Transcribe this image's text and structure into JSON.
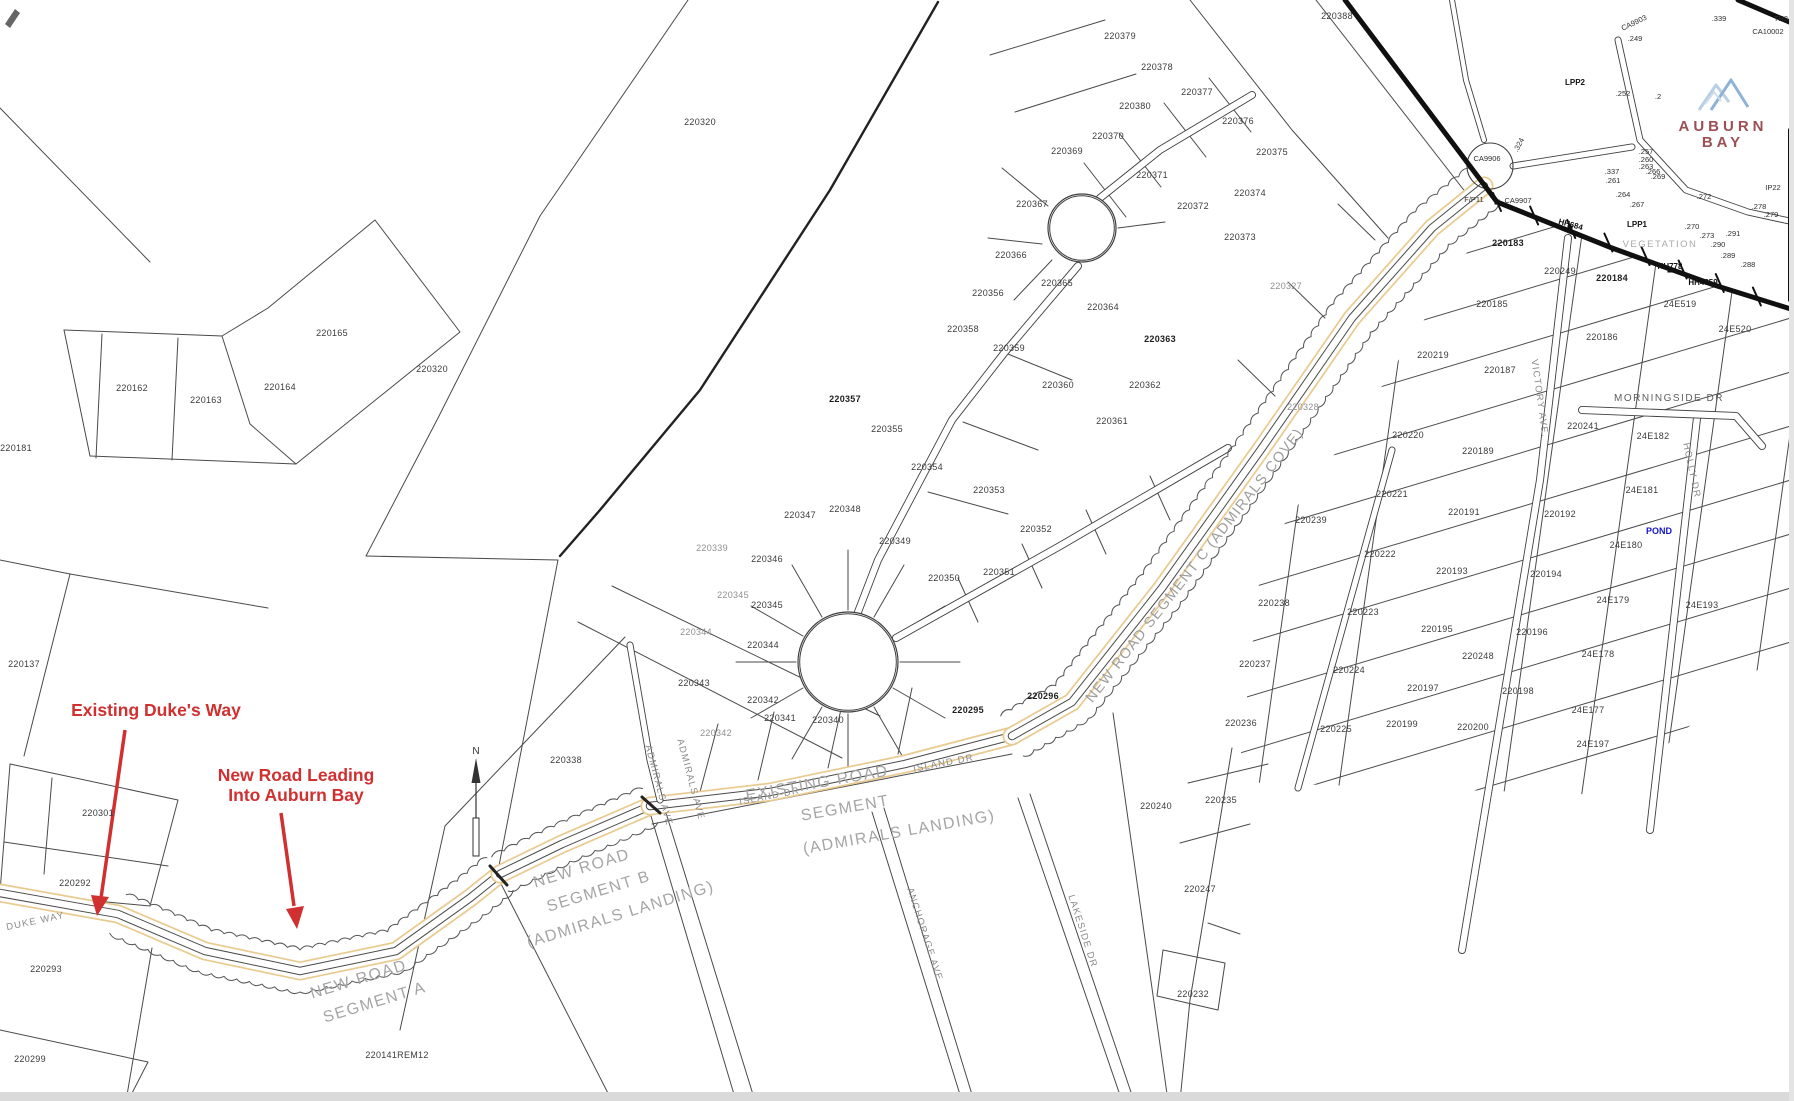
{
  "page": {
    "background": "#ffffff"
  },
  "colors": {
    "annotation_red": "#d03030",
    "road_orange": "#e9cb90",
    "pond_blue": "#1414cc",
    "logo_blue": "#a3c2de",
    "logo_text": "#9a5054",
    "line": "#3c3c3c",
    "segment_text_gray": "#a5a5a5",
    "edge_strip": "#dadada"
  },
  "logo": {
    "line1": "AUBURN",
    "line2": "BAY"
  },
  "annotations": {
    "existing_label": "Existing Duke's Way",
    "new_road_line1": "New Road Leading",
    "new_road_line2": "Into Auburn Bay"
  },
  "north": {
    "label": "N"
  },
  "map": {
    "labels": [
      {
        "t": "220388",
        "x": 1337,
        "y": 19
      },
      {
        "t": "220379",
        "x": 1120,
        "y": 39
      },
      {
        "t": "220378",
        "x": 1157,
        "y": 70
      },
      {
        "t": "220377",
        "x": 1197,
        "y": 95
      },
      {
        "t": "220376",
        "x": 1238,
        "y": 124
      },
      {
        "t": "220375",
        "x": 1272,
        "y": 155
      },
      {
        "t": "220380",
        "x": 1135,
        "y": 109
      },
      {
        "t": "220370",
        "x": 1108,
        "y": 139
      },
      {
        "t": "220369",
        "x": 1067,
        "y": 154
      },
      {
        "t": "220371",
        "x": 1152,
        "y": 178
      },
      {
        "t": "220367",
        "x": 1032,
        "y": 207
      },
      {
        "t": "220372",
        "x": 1193,
        "y": 209
      },
      {
        "t": "220374",
        "x": 1250,
        "y": 196
      },
      {
        "t": "220373",
        "x": 1240,
        "y": 240
      },
      {
        "t": "220366",
        "x": 1011,
        "y": 258
      },
      {
        "t": "220365",
        "x": 1057,
        "y": 286
      },
      {
        "t": "220364",
        "x": 1103,
        "y": 310
      },
      {
        "t": "220363",
        "x": 1160,
        "y": 342,
        "c": "b"
      },
      {
        "t": "220356",
        "x": 988,
        "y": 296
      },
      {
        "t": "220357",
        "x": 845,
        "y": 402,
        "c": "b"
      },
      {
        "t": "220358",
        "x": 963,
        "y": 332
      },
      {
        "t": "220359",
        "x": 1009,
        "y": 351
      },
      {
        "t": "220360",
        "x": 1058,
        "y": 388
      },
      {
        "t": "220362",
        "x": 1145,
        "y": 388
      },
      {
        "t": "220361",
        "x": 1112,
        "y": 424
      },
      {
        "t": "220355",
        "x": 887,
        "y": 432
      },
      {
        "t": "220354",
        "x": 927,
        "y": 470
      },
      {
        "t": "220353",
        "x": 989,
        "y": 493
      },
      {
        "t": "220352",
        "x": 1036,
        "y": 532
      },
      {
        "t": "220351",
        "x": 999,
        "y": 575
      },
      {
        "t": "220350",
        "x": 944,
        "y": 581
      },
      {
        "t": "220349",
        "x": 895,
        "y": 544
      },
      {
        "t": "220348",
        "x": 845,
        "y": 512
      },
      {
        "t": "220347",
        "x": 800,
        "y": 518
      },
      {
        "t": "220346",
        "x": 767,
        "y": 562
      },
      {
        "t": "220345",
        "x": 733,
        "y": 598,
        "c": "g"
      },
      {
        "t": "220345",
        "x": 767,
        "y": 608
      },
      {
        "t": "220344",
        "x": 696,
        "y": 635,
        "c": "g"
      },
      {
        "t": "220344",
        "x": 763,
        "y": 648
      },
      {
        "t": "220343",
        "x": 694,
        "y": 686
      },
      {
        "t": "220342",
        "x": 763,
        "y": 703
      },
      {
        "t": "220342",
        "x": 716,
        "y": 736,
        "c": "g"
      },
      {
        "t": "220341",
        "x": 780,
        "y": 721
      },
      {
        "t": "220340",
        "x": 828,
        "y": 723
      },
      {
        "t": "220339",
        "x": 712,
        "y": 551,
        "c": "g"
      },
      {
        "t": "220338",
        "x": 566,
        "y": 763
      },
      {
        "t": "220320",
        "x": 700,
        "y": 125
      },
      {
        "t": "220320",
        "x": 432,
        "y": 372
      },
      {
        "t": "220162",
        "x": 132,
        "y": 391
      },
      {
        "t": "220163",
        "x": 206,
        "y": 403
      },
      {
        "t": "220164",
        "x": 280,
        "y": 390
      },
      {
        "t": "220165",
        "x": 332,
        "y": 336
      },
      {
        "t": "220181",
        "x": 16,
        "y": 451
      },
      {
        "t": "220137",
        "x": 24,
        "y": 667
      },
      {
        "t": "220301",
        "x": 98,
        "y": 816
      },
      {
        "t": "220292",
        "x": 75,
        "y": 886
      },
      {
        "t": "220293",
        "x": 46,
        "y": 972
      },
      {
        "t": "220299",
        "x": 30,
        "y": 1062
      },
      {
        "t": "220141REM12",
        "x": 397,
        "y": 1058
      },
      {
        "t": "220295",
        "x": 968,
        "y": 713,
        "c": "b"
      },
      {
        "t": "220296",
        "x": 1043,
        "y": 699,
        "c": "b"
      },
      {
        "t": "220183",
        "x": 1508,
        "y": 246,
        "c": "b"
      },
      {
        "t": "220249",
        "x": 1560,
        "y": 274
      },
      {
        "t": "220184",
        "x": 1612,
        "y": 281,
        "c": "b"
      },
      {
        "t": "24E519",
        "x": 1680,
        "y": 307
      },
      {
        "t": "24E520",
        "x": 1735,
        "y": 332
      },
      {
        "t": "220185",
        "x": 1492,
        "y": 307
      },
      {
        "t": "220186",
        "x": 1602,
        "y": 340
      },
      {
        "t": "220219",
        "x": 1433,
        "y": 358
      },
      {
        "t": "220187",
        "x": 1500,
        "y": 373
      },
      {
        "t": "220327",
        "x": 1286,
        "y": 289,
        "c": "g"
      },
      {
        "t": "220328",
        "x": 1303,
        "y": 410,
        "c": "g"
      },
      {
        "t": "220241",
        "x": 1583,
        "y": 429
      },
      {
        "t": "24E182",
        "x": 1653,
        "y": 439
      },
      {
        "t": "220220",
        "x": 1408,
        "y": 438
      },
      {
        "t": "220189",
        "x": 1478,
        "y": 454
      },
      {
        "t": "24E181",
        "x": 1642,
        "y": 493
      },
      {
        "t": "220221",
        "x": 1392,
        "y": 497
      },
      {
        "t": "220191",
        "x": 1464,
        "y": 515
      },
      {
        "t": "220192",
        "x": 1560,
        "y": 517
      },
      {
        "t": "24E180",
        "x": 1626,
        "y": 548
      },
      {
        "t": "220222",
        "x": 1380,
        "y": 557
      },
      {
        "t": "220193",
        "x": 1452,
        "y": 574
      },
      {
        "t": "220194",
        "x": 1546,
        "y": 577
      },
      {
        "t": "24E179",
        "x": 1613,
        "y": 603
      },
      {
        "t": "24E193",
        "x": 1702,
        "y": 608
      },
      {
        "t": "220239",
        "x": 1311,
        "y": 523
      },
      {
        "t": "220238",
        "x": 1274,
        "y": 606
      },
      {
        "t": "220223",
        "x": 1363,
        "y": 615
      },
      {
        "t": "220195",
        "x": 1437,
        "y": 632
      },
      {
        "t": "220196",
        "x": 1532,
        "y": 635
      },
      {
        "t": "24E178",
        "x": 1598,
        "y": 657
      },
      {
        "t": "220237",
        "x": 1255,
        "y": 667
      },
      {
        "t": "220224",
        "x": 1349,
        "y": 673
      },
      {
        "t": "220248",
        "x": 1478,
        "y": 659
      },
      {
        "t": "220197",
        "x": 1423,
        "y": 691
      },
      {
        "t": "220198",
        "x": 1518,
        "y": 694
      },
      {
        "t": "24E177",
        "x": 1588,
        "y": 713
      },
      {
        "t": "220236",
        "x": 1241,
        "y": 726
      },
      {
        "t": "220225",
        "x": 1336,
        "y": 732
      },
      {
        "t": "220199",
        "x": 1402,
        "y": 727
      },
      {
        "t": "220200",
        "x": 1473,
        "y": 730
      },
      {
        "t": "24E197",
        "x": 1593,
        "y": 747
      },
      {
        "t": "220240",
        "x": 1156,
        "y": 809
      },
      {
        "t": "220235",
        "x": 1221,
        "y": 803
      },
      {
        "t": "220247",
        "x": 1200,
        "y": 892
      },
      {
        "t": "220232",
        "x": 1193,
        "y": 997
      },
      {
        "t": "CA9903",
        "x": 1635,
        "y": 25,
        "r": -25,
        "c": "tiny"
      },
      {
        "t": "CA10002",
        "x": 1768,
        "y": 34,
        "c": "tiny"
      },
      {
        "t": "TH34",
        "x": 1783,
        "y": 21,
        "c": "tiny"
      },
      {
        "t": ".339",
        "x": 1719,
        "y": 21,
        "c": "tiny"
      },
      {
        "t": ".249",
        "x": 1635,
        "y": 41,
        "c": "tiny"
      },
      {
        "t": "LPP2",
        "x": 1575,
        "y": 85,
        "c": "tinyb"
      },
      {
        "t": ".252",
        "x": 1623,
        "y": 96,
        "c": "tiny"
      },
      {
        "t": ".2",
        "x": 1658,
        "y": 99,
        "c": "tiny"
      },
      {
        "t": "CA9906",
        "x": 1487,
        "y": 161,
        "c": "tiny"
      },
      {
        "t": ".324",
        "x": 1521,
        "y": 146,
        "r": -62,
        "c": "tiny"
      },
      {
        "t": ".337",
        "x": 1612,
        "y": 174,
        "c": "tiny"
      },
      {
        "t": ".261",
        "x": 1613,
        "y": 183,
        "c": "tiny"
      },
      {
        "t": ".257",
        "x": 1646,
        "y": 154,
        "c": "tiny"
      },
      {
        "t": ".260",
        "x": 1646,
        "y": 162,
        "c": "tiny"
      },
      {
        "t": ".263",
        "x": 1646,
        "y": 169,
        "c": "tiny"
      },
      {
        "t": ".266",
        "x": 1653,
        "y": 174,
        "c": "tiny"
      },
      {
        "t": ".269",
        "x": 1658,
        "y": 179,
        "c": "tiny"
      },
      {
        "t": ".264",
        "x": 1623,
        "y": 197,
        "c": "tiny"
      },
      {
        "t": ".267",
        "x": 1637,
        "y": 207,
        "c": "tiny"
      },
      {
        "t": "LPP1",
        "x": 1637,
        "y": 227,
        "c": "tinyb"
      },
      {
        "t": ".270",
        "x": 1692,
        "y": 229,
        "c": "tiny"
      },
      {
        "t": ".272",
        "x": 1704,
        "y": 199,
        "c": "tiny"
      },
      {
        "t": ".273",
        "x": 1707,
        "y": 238,
        "c": "tiny"
      },
      {
        "t": ".290",
        "x": 1718,
        "y": 247,
        "c": "tiny"
      },
      {
        "t": ".291",
        "x": 1733,
        "y": 236,
        "c": "tiny"
      },
      {
        "t": ".278",
        "x": 1759,
        "y": 209,
        "c": "tiny"
      },
      {
        "t": ".279",
        "x": 1771,
        "y": 217,
        "c": "tiny"
      },
      {
        "t": ".288",
        "x": 1748,
        "y": 267,
        "c": "tiny"
      },
      {
        "t": ".289",
        "x": 1728,
        "y": 258,
        "c": "tiny"
      },
      {
        "t": "HH684",
        "x": 1570,
        "y": 227,
        "r": 15,
        "c": "tinyb"
      },
      {
        "t": "HH778",
        "x": 1670,
        "y": 269,
        "c": "tinyb"
      },
      {
        "t": "HH4359",
        "x": 1703,
        "y": 285,
        "c": "tinyb"
      },
      {
        "t": "F/P11",
        "x": 1474,
        "y": 202,
        "c": "tiny"
      },
      {
        "t": "CA9907",
        "x": 1518,
        "y": 203,
        "c": "tiny"
      },
      {
        "t": "IP22",
        "x": 1773,
        "y": 190,
        "c": "tiny"
      },
      {
        "t": "VEGETATION",
        "x": 1660,
        "y": 247,
        "c": "veg"
      },
      {
        "t": "POND",
        "x": 1659,
        "y": 534,
        "c": "pond"
      },
      {
        "t": "ISLAND DR",
        "x": 770,
        "y": 799,
        "r": -11,
        "c": "road"
      },
      {
        "t": "ISLAND DR",
        "x": 944,
        "y": 766,
        "r": -11,
        "c": "road"
      },
      {
        "t": "DUKE WAY",
        "x": 36,
        "y": 924,
        "r": -12,
        "c": "road"
      },
      {
        "t": "ADMIRALS AVE",
        "x": 656,
        "y": 786,
        "r": 75,
        "c": "road"
      },
      {
        "t": "ADMIRALS AVE",
        "x": 688,
        "y": 780,
        "r": 75,
        "c": "road"
      },
      {
        "t": "VICTORY AVE.",
        "x": 1537,
        "y": 399,
        "r": 82,
        "c": "road"
      },
      {
        "t": "MORNINGSIDE DR",
        "x": 1669,
        "y": 401,
        "c": "roadd"
      },
      {
        "t": "HOLLY DR",
        "x": 1689,
        "y": 471,
        "r": 78,
        "c": "road"
      },
      {
        "t": "ANCHORAGE AVE",
        "x": 922,
        "y": 935,
        "r": 72,
        "c": "road"
      },
      {
        "t": "LAKESIDE DR",
        "x": 1080,
        "y": 932,
        "r": 72,
        "c": "road"
      },
      {
        "t": "NEW ROAD SEGMENT C (ADMIRALS COVE)",
        "x": 1198,
        "y": 568,
        "r": -52,
        "c": "segc"
      },
      {
        "t": "EXISTING ROAD",
        "x": 818,
        "y": 788,
        "r": -10,
        "c": "seg"
      },
      {
        "t": "SEGMENT",
        "x": 846,
        "y": 813,
        "r": -10,
        "c": "seg"
      },
      {
        "t": "(ADMIRALS LANDING)",
        "x": 900,
        "y": 837,
        "r": -10,
        "c": "seg"
      },
      {
        "t": "NEW ROAD",
        "x": 583,
        "y": 873,
        "r": -17,
        "c": "seg"
      },
      {
        "t": "SEGMENT B",
        "x": 600,
        "y": 896,
        "r": -17,
        "c": "seg"
      },
      {
        "t": "(ADMIRALS LANDING)",
        "x": 622,
        "y": 919,
        "r": -17,
        "c": "seg"
      },
      {
        "t": "NEW ROAD",
        "x": 360,
        "y": 984,
        "r": -17,
        "c": "seg"
      },
      {
        "t": "SEGMENT A",
        "x": 376,
        "y": 1007,
        "r": -17,
        "c": "seg"
      },
      {
        "t": "Existing Duke's Way",
        "x": 156,
        "y": 716,
        "c": "red"
      },
      {
        "t": "New Road Leading",
        "x": 296,
        "y": 781,
        "c": "red"
      },
      {
        "t": "Into Auburn Bay",
        "x": 296,
        "y": 801,
        "c": "red"
      },
      {
        "t": "N",
        "x": 476,
        "y": 754,
        "c": "nlab"
      }
    ]
  }
}
